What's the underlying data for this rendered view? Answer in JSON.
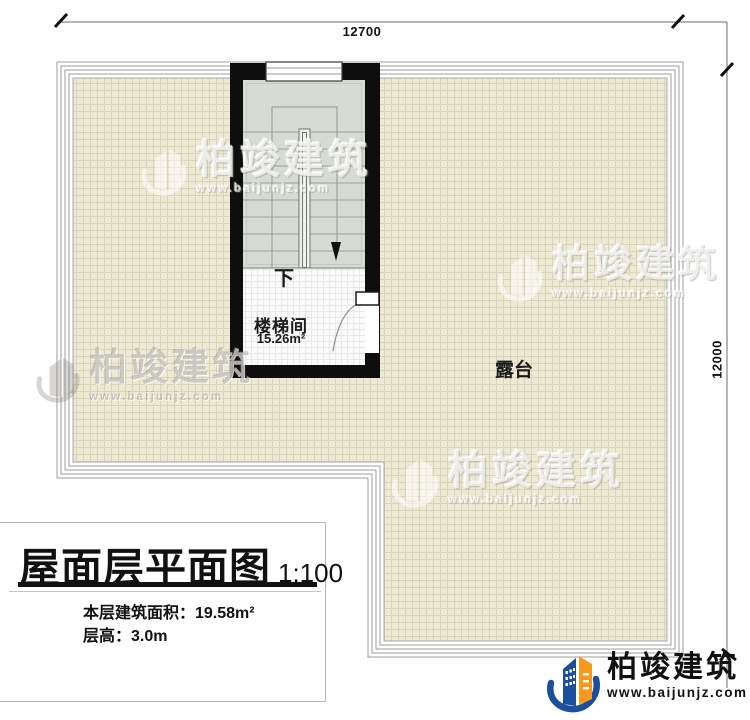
{
  "dims": {
    "top": "12700",
    "right": "12000"
  },
  "plan": {
    "terrace": "露台",
    "stair_room": "楼梯间",
    "stair_area": "15.26m²",
    "stair_down": "下"
  },
  "title_block": {
    "title": "屋面层平面图",
    "scale": "1:100",
    "area": "本层建筑面积：19.58m²",
    "floor_height": "层高：3.0m"
  },
  "brand": {
    "company": "柏竣建筑",
    "website": "www.baijunjz.com"
  },
  "watermark": {
    "company": "柏竣建筑",
    "website": "www.baijunjz.com"
  },
  "colors": {
    "wall": "#111111",
    "terrace_floor": "#ece9d5",
    "terrace_grid_line": "#d9d3b8",
    "stair_floor": "#d7dcd3",
    "landing_floor": "#fbfbfb",
    "parapet_line": "#9c9c9c",
    "brand_blue": "#1b4f9e",
    "brand_orange": "#f6991e"
  }
}
